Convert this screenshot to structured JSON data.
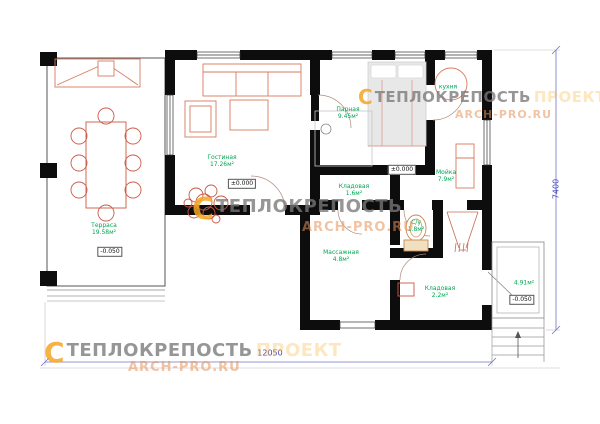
{
  "watermark": {
    "logo_glyph": "C",
    "brand": "ТЕПЛОКРЕПОСТЬ",
    "accent": "ПРОЕКТ",
    "site": "ARCH-PRO.RU"
  },
  "rooms": [
    {
      "name": "Терраса",
      "area": "19.58м²"
    },
    {
      "name": "Гостиная",
      "area": "17.26м²"
    },
    {
      "name": "Парная",
      "area": "9.45м²"
    },
    {
      "name": "кухня",
      "area": ""
    },
    {
      "name": "Мойка",
      "area": "7.9м²"
    },
    {
      "name": "Кладовая",
      "area": "1.6м²"
    },
    {
      "name": "Массажная",
      "area": "4.8м²"
    },
    {
      "name": "С/у",
      "area": "1.8м²"
    },
    {
      "name": "Кладовая",
      "area": "2.2м²"
    },
    {
      "name": "",
      "area": "4.91м²"
    }
  ],
  "elevations": [
    {
      "value": "-0.050"
    },
    {
      "value": "±0.000"
    },
    {
      "value": "±0.000"
    },
    {
      "value": "-0.050"
    }
  ],
  "dimensions": {
    "bottom": "12050",
    "right": "7400"
  },
  "colors": {
    "wall": "#0d0d0d",
    "furniture": "#d87a5e",
    "label_green": "#00a651",
    "dimension_blue": "#4444bb",
    "logo_orange": "#f5a623"
  }
}
